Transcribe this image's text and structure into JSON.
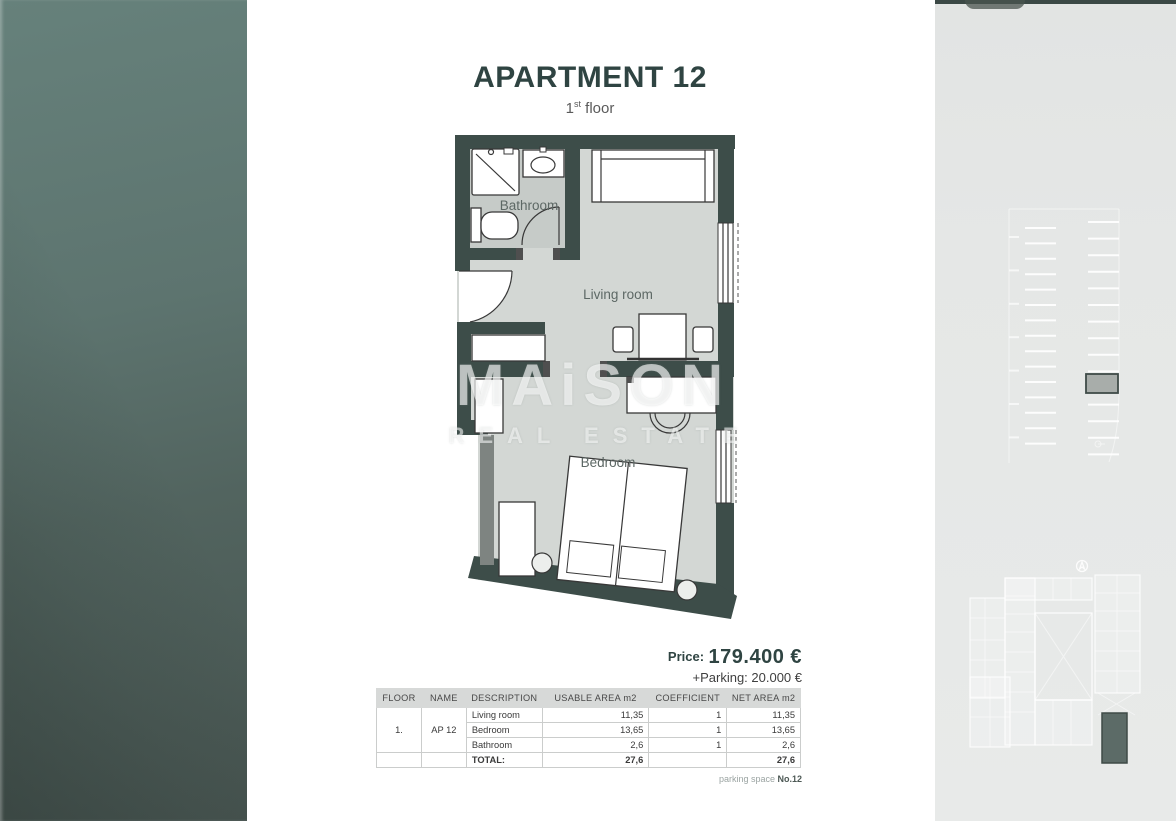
{
  "header": {
    "title": "APARTMENT 12",
    "floor_num": "1",
    "floor_sup": "st",
    "floor_rest": " floor"
  },
  "plan": {
    "labels": {
      "bathroom": "Bathroom",
      "living": "Living room",
      "bedroom": "Bedroom"
    }
  },
  "watermark": {
    "part1": "MA",
    "part2": "i",
    "part3": "SON",
    "line2": "REAL ESTATE"
  },
  "pricing": {
    "price_label": "Price:",
    "price_value": "179.400 €",
    "parking_line": "+Parking: 20.000 €"
  },
  "table": {
    "headers": [
      "FLOOR",
      "NAME",
      "DESCRIPTION",
      "USABLE AREA m2",
      "COEFFICIENT",
      "NET AREA m2"
    ],
    "floor": "1.",
    "name": "AP 12",
    "rows": [
      {
        "description": "Living room",
        "usable": "11,35",
        "coefficient": "1",
        "net": "11,35"
      },
      {
        "description": "Bedroom",
        "usable": "13,65",
        "coefficient": "1",
        "net": "13,65"
      },
      {
        "description": "Bathroom",
        "usable": "2,6",
        "coefficient": "1",
        "net": "2,6"
      }
    ],
    "total_label": "TOTAL:",
    "total_usable": "27,6",
    "total_net": "27,6"
  },
  "parking_note": {
    "prefix": "parking space ",
    "number": "No.12"
  },
  "colors": {
    "accent": "#2f4442",
    "wall": "#3d4d49",
    "floor-main": "#d3d7d4",
    "floor-bath": "#c6cbc8",
    "band-top": "#66817b",
    "band-bottom": "#475450",
    "panel-bg": "#e5e7e6",
    "highlight": "#5c6b67"
  }
}
